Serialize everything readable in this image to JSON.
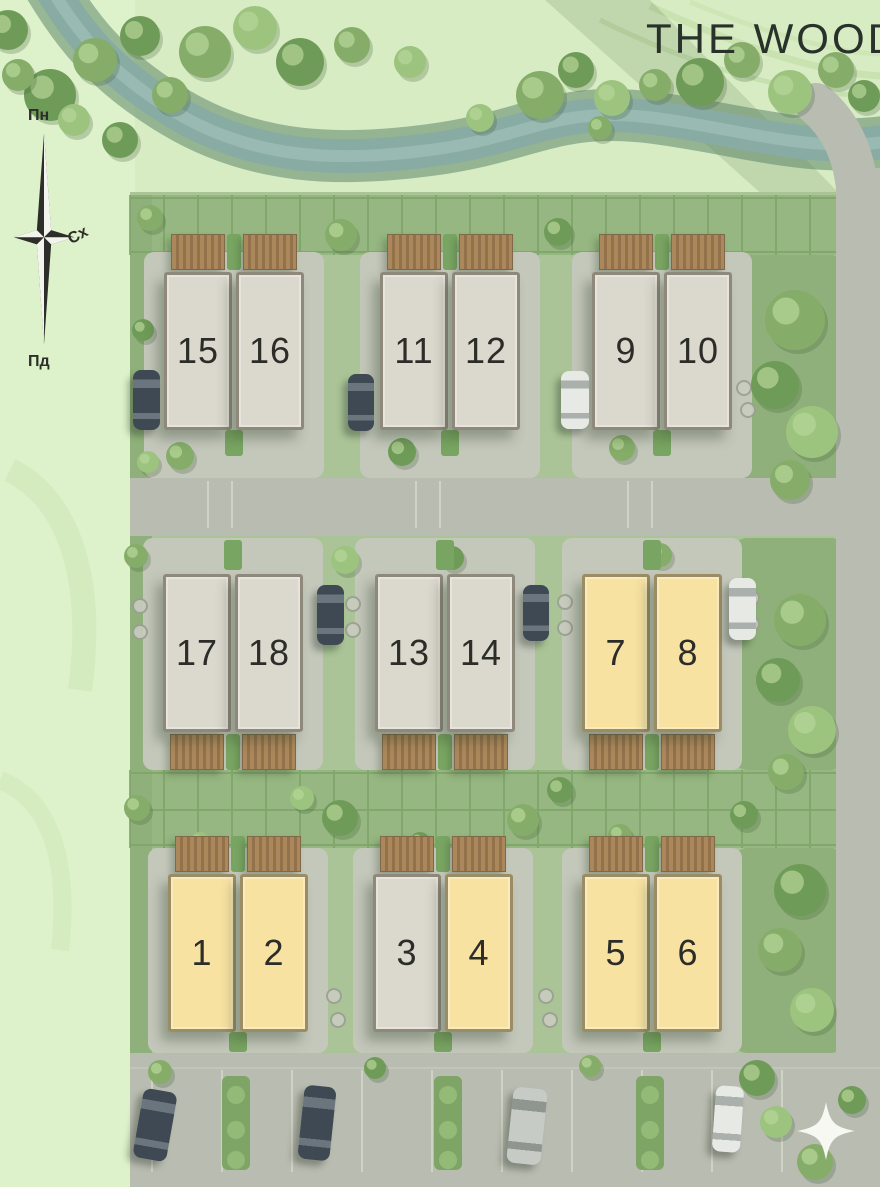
{
  "title": "THE WOOD",
  "compass": {
    "north": "Пн",
    "east": "Сх",
    "south": "Пд"
  },
  "palette": {
    "unit_highlighted": "#F7E2A2",
    "unit_default": "#DBD8CE",
    "unit_border": "#8F897B",
    "unit_number": "#2C2C28",
    "terrace_wood": "#A8855A",
    "street": "#B9BCB0",
    "garden": "#96B781",
    "field": "#D7ECC3",
    "river": "#87ABA4"
  },
  "units": [
    {
      "number": "1",
      "highlighted": true
    },
    {
      "number": "2",
      "highlighted": true
    },
    {
      "number": "3",
      "highlighted": false
    },
    {
      "number": "4",
      "highlighted": true
    },
    {
      "number": "5",
      "highlighted": true
    },
    {
      "number": "6",
      "highlighted": true
    },
    {
      "number": "7",
      "highlighted": true
    },
    {
      "number": "8",
      "highlighted": true
    },
    {
      "number": "9",
      "highlighted": false
    },
    {
      "number": "10",
      "highlighted": false
    },
    {
      "number": "11",
      "highlighted": false
    },
    {
      "number": "12",
      "highlighted": false
    },
    {
      "number": "13",
      "highlighted": false
    },
    {
      "number": "14",
      "highlighted": false
    },
    {
      "number": "15",
      "highlighted": false
    },
    {
      "number": "16",
      "highlighted": false
    },
    {
      "number": "17",
      "highlighted": false
    },
    {
      "number": "18",
      "highlighted": false
    }
  ],
  "site_plan": {
    "unit_size": {
      "w": 68,
      "h": 158,
      "gap": 4
    },
    "rows": [
      {
        "terrace_side": "top",
        "y": 272,
        "pairs": [
          {
            "x": 164,
            "units": [
              "15",
              "16"
            ]
          },
          {
            "x": 380,
            "units": [
              "11",
              "12"
            ]
          },
          {
            "x": 592,
            "units": [
              "9",
              "10"
            ]
          }
        ]
      },
      {
        "terrace_side": "bottom",
        "y": 574,
        "pairs": [
          {
            "x": 163,
            "units": [
              "17",
              "18"
            ]
          },
          {
            "x": 375,
            "units": [
              "13",
              "14"
            ]
          },
          {
            "x": 582,
            "units": [
              "7",
              "8"
            ]
          }
        ]
      },
      {
        "terrace_side": "top",
        "y": 874,
        "pairs": [
          {
            "x": 168,
            "units": [
              "1",
              "2"
            ]
          },
          {
            "x": 373,
            "units": [
              "3",
              "4"
            ]
          },
          {
            "x": 582,
            "units": [
              "5",
              "6"
            ]
          }
        ]
      }
    ],
    "cars": [
      {
        "shade": "dark",
        "x": 133,
        "y": 370,
        "w": 27,
        "h": 60,
        "rot": 0
      },
      {
        "shade": "dark",
        "x": 348,
        "y": 374,
        "w": 26,
        "h": 57,
        "rot": 0
      },
      {
        "shade": "white",
        "x": 561,
        "y": 371,
        "w": 28,
        "h": 58,
        "rot": 0
      },
      {
        "shade": "dark",
        "x": 317,
        "y": 585,
        "w": 27,
        "h": 60,
        "rot": 0
      },
      {
        "shade": "dark",
        "x": 523,
        "y": 585,
        "w": 26,
        "h": 56,
        "rot": 0
      },
      {
        "shade": "white",
        "x": 729,
        "y": 578,
        "w": 27,
        "h": 62,
        "rot": 0
      },
      {
        "shade": "dark",
        "x": 138,
        "y": 1090,
        "w": 34,
        "h": 70,
        "rot": 10
      },
      {
        "shade": "dark",
        "x": 301,
        "y": 1086,
        "w": 32,
        "h": 74,
        "rot": 6
      },
      {
        "shade": "silver",
        "x": 510,
        "y": 1088,
        "w": 34,
        "h": 76,
        "rot": 6
      },
      {
        "shade": "white",
        "x": 714,
        "y": 1086,
        "w": 28,
        "h": 66,
        "rot": 4
      }
    ]
  }
}
